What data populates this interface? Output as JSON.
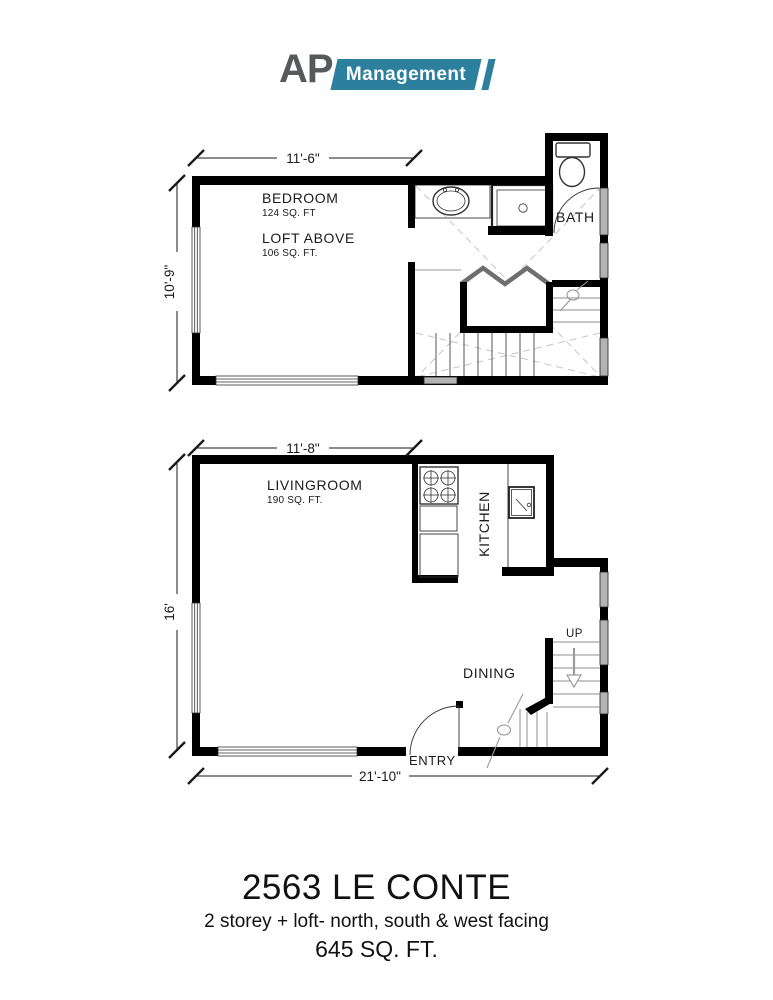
{
  "logo": {
    "ap": "AP",
    "management": "Management",
    "brand_teal": "#2D7F9E",
    "brand_gray": "#58595B"
  },
  "upper_plan": {
    "dimensions": {
      "width": "11'-6\"",
      "height": "10'-9\""
    },
    "labels": {
      "bedroom": "BEDROOM",
      "bedroom_area": "124 SQ. FT",
      "loft": "LOFT ABOVE",
      "loft_area": "106 SQ. FT.",
      "bath": "BATH"
    }
  },
  "lower_plan": {
    "dimensions": {
      "width": "11'-8\"",
      "height": "16'",
      "overall_width": "21'-10\""
    },
    "labels": {
      "livingroom": "LIVINGROOM",
      "livingroom_area": "190 SQ. FT.",
      "kitchen": "KITCHEN",
      "dining": "DINING",
      "up": "UP",
      "entry": "ENTRY"
    }
  },
  "title_block": {
    "title": "2563 LE CONTE",
    "subtitle": "2 storey + loft- north, south & west facing",
    "total_area": "645 SQ. FT."
  }
}
